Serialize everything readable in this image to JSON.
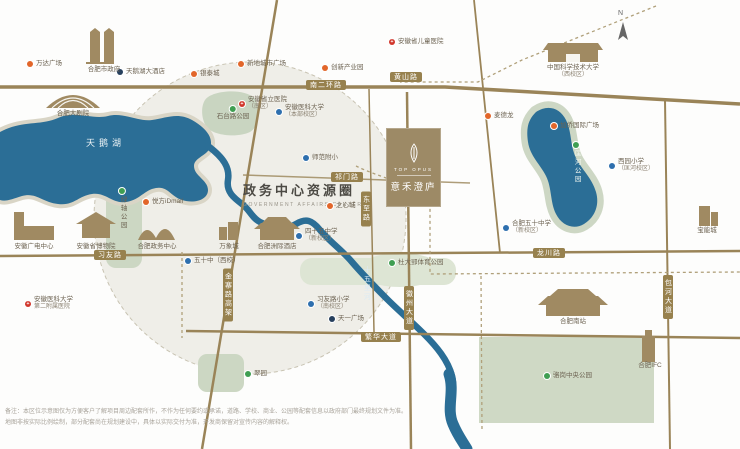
{
  "map": {
    "title": "政务中心资源圈",
    "subtitle_en": "GOVERNMENT AFFAIRS CENTER",
    "lake_label": "天鹅湖",
    "compass_letter": "N",
    "project_card": {
      "logo": "leaf-icon",
      "name_en": "TOP OPUS",
      "name_cn": "意禾澄庐"
    },
    "colors": {
      "road": "#9a8458",
      "badge": "#97814e",
      "water": "#2b6e96",
      "zone_fill": "#efeee8",
      "park": "#ccd7c3",
      "brand": "#9d8a66",
      "mall_dot": "#e2662a",
      "hospital_dot": "#d1372c",
      "school_dot": "#2e6fae",
      "hotel_dot": "#27405d",
      "park_dot": "#3f9e52"
    },
    "road_badges": [
      {
        "label": "南二环路",
        "x": 326,
        "y": 85,
        "orient": "h"
      },
      {
        "label": "黄山路",
        "x": 406,
        "y": 77,
        "orient": "h"
      },
      {
        "label": "祁门路",
        "x": 347,
        "y": 177,
        "orient": "h"
      },
      {
        "label": "习友路",
        "x": 110,
        "y": 255,
        "orient": "h"
      },
      {
        "label": "龙川路",
        "x": 549,
        "y": 253,
        "orient": "h"
      },
      {
        "label": "繁华大道",
        "x": 381,
        "y": 337,
        "orient": "h"
      },
      {
        "label": "东至路",
        "x": 366,
        "y": 209,
        "orient": "v"
      },
      {
        "label": "徽州大道",
        "x": 409,
        "y": 308,
        "orient": "v"
      },
      {
        "label": "包河大道",
        "x": 668,
        "y": 297,
        "orient": "v"
      },
      {
        "label": "金寨路高架",
        "x": 228,
        "y": 295,
        "orient": "v"
      }
    ],
    "pois": [
      {
        "t": "mall",
        "label": "万达广场",
        "x": 30,
        "y": 64,
        "lp": "r"
      },
      {
        "t": "hotel",
        "label": "天鹅湖大酒店",
        "x": 120,
        "y": 72,
        "lp": "r"
      },
      {
        "t": "mall",
        "label": "银泰城",
        "x": 194,
        "y": 74,
        "lp": "r"
      },
      {
        "t": "mall",
        "label": "新地城市广场",
        "x": 241,
        "y": 64,
        "lp": "r"
      },
      {
        "t": "mall",
        "label": "创新产业园",
        "x": 325,
        "y": 68,
        "lp": "r"
      },
      {
        "t": "hospital",
        "label": "安徽省儿童医院",
        "x": 392,
        "y": 42,
        "lp": "r"
      },
      {
        "t": "mall",
        "label": "麦德龙",
        "x": 488,
        "y": 116,
        "lp": "r"
      },
      {
        "t": "mall",
        "label": "加侨国际广场",
        "x": 554,
        "y": 126,
        "lp": "r"
      },
      {
        "t": "school",
        "label": "西园小学",
        "sub": "（匡河校区）",
        "x": 612,
        "y": 162,
        "lp": "r"
      },
      {
        "t": "school",
        "label": "合肥五十中学",
        "sub": "（新校区）",
        "x": 506,
        "y": 224,
        "lp": "r"
      },
      {
        "t": "park",
        "label": "杜大郢体育公园",
        "x": 392,
        "y": 263,
        "lp": "r"
      },
      {
        "t": "school",
        "label": "习友路小学",
        "sub": "（南校区）",
        "x": 311,
        "y": 300,
        "lp": "r"
      },
      {
        "t": "school",
        "label": "四十五中学",
        "sub": "（新校区）",
        "x": 299,
        "y": 232,
        "lp": "r"
      },
      {
        "t": "school",
        "label": "师范附小",
        "x": 306,
        "y": 158,
        "lp": "r"
      },
      {
        "t": "mall",
        "label": "之心城",
        "x": 330,
        "y": 206,
        "lp": "r"
      },
      {
        "t": "school",
        "label": "安徽医科大学",
        "sub": "（本部校区）",
        "x": 279,
        "y": 108,
        "lp": "r"
      },
      {
        "t": "hospital",
        "label": "安徽省立医院",
        "sub": "（南区）",
        "x": 242,
        "y": 100,
        "lp": "r"
      },
      {
        "t": "park",
        "label": "石台路公园",
        "x": 233,
        "y": 106,
        "lp": "b"
      },
      {
        "t": "mall",
        "label": "悦方iDmall",
        "x": 146,
        "y": 202,
        "lp": "r"
      },
      {
        "t": "school",
        "label": "五十中（西校）",
        "x": 188,
        "y": 261,
        "lp": "r"
      },
      {
        "t": "hospital",
        "label": "安徽医科大学",
        "sub": "第二附属医院",
        "x": 28,
        "y": 300,
        "lp": "r"
      },
      {
        "t": "hotel",
        "label": "天一广场",
        "x": 332,
        "y": 319,
        "lp": "r"
      },
      {
        "t": "park",
        "label": "翠园",
        "x": 248,
        "y": 374,
        "lp": "r"
      },
      {
        "t": "park",
        "label": "骆岗中央公园",
        "x": 547,
        "y": 376,
        "lp": "r"
      },
      {
        "t": "building",
        "label": "合肥市政府",
        "x": 104,
        "y": 66,
        "lp": "c"
      },
      {
        "t": "building",
        "label": "合肥大剧院",
        "x": 73,
        "y": 110,
        "lp": "c"
      },
      {
        "t": "building",
        "label": "安徽广电中心",
        "x": 34,
        "y": 243,
        "lp": "c"
      },
      {
        "t": "building",
        "label": "安徽省博物院",
        "x": 96,
        "y": 243,
        "lp": "c"
      },
      {
        "t": "building",
        "label": "合肥政务中心",
        "x": 157,
        "y": 243,
        "lp": "c"
      },
      {
        "t": "building",
        "label": "万象城",
        "x": 229,
        "y": 243,
        "lp": "c"
      },
      {
        "t": "building",
        "label": "合肥洲际酒店",
        "x": 277,
        "y": 243,
        "lp": "c"
      },
      {
        "t": "building",
        "label": "中国科学技术大学",
        "sub": "（西校区）",
        "x": 573,
        "y": 64,
        "lp": "c"
      },
      {
        "t": "building",
        "label": "合肥南站",
        "x": 573,
        "y": 318,
        "lp": "c"
      },
      {
        "t": "building",
        "label": "合肥IFC",
        "x": 650,
        "y": 362,
        "lp": "c"
      },
      {
        "t": "building",
        "label": "宝能城",
        "x": 707,
        "y": 227,
        "lp": "c"
      },
      {
        "t": "park",
        "label": "匡河公园",
        "x": 576,
        "y": 142,
        "lp": "vert",
        "cls": "park-on-water"
      },
      {
        "t": "park",
        "label": "绿轴公园",
        "x": 122,
        "y": 188,
        "lp": "vert"
      },
      {
        "t": "river",
        "label": "十五里河",
        "x": 366,
        "y": 266,
        "lp": "vert",
        "cls": "river-name"
      }
    ],
    "disclaimer": [
      "备注：本区位示意图仅为方便客户了解项目周边配套所作，不作为任何要约或承诺，道路、学校、商业、公园等配套信息以政府部门最终规划文件为准。",
      "地图非按实际比例绘制，部分配套尚在规划建设中，具体以实际交付为准，开发商保留对宣传内容的解释权。"
    ]
  }
}
